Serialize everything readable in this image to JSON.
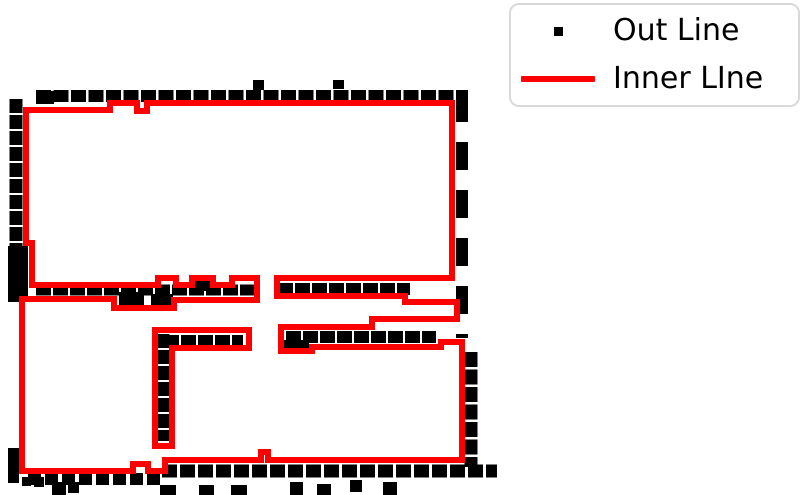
{
  "figure": {
    "background": "#ffffff"
  },
  "legend": {
    "position": "upper right",
    "border_color": "#d9d9d9",
    "items": [
      {
        "label": "Out Line",
        "color": "#000000",
        "marker": "square"
      },
      {
        "label": "Inner LIne",
        "color": "#ff0000",
        "marker": "line"
      }
    ]
  },
  "chart_data": {
    "type": "line",
    "title": "",
    "axes_visible": false,
    "grid": false,
    "coordinate_units": "image pixels, y-down, canvas 800x495",
    "legend_position": "upper right",
    "series": [
      {
        "name": "Out Line",
        "kind": "scatter",
        "marker": "square",
        "color": "#000000",
        "segments": [
          [
            36,
            96,
            466,
            96,
            12,
            "15 2.5"
          ],
          [
            16,
            99,
            16,
            302,
            13,
            "14 2"
          ],
          [
            462,
            94,
            462,
            338,
            12,
            "28 20"
          ],
          [
            471,
            352,
            471,
            467,
            13,
            "15 2.5"
          ],
          [
            36,
            290,
            256,
            290,
            11,
            "15 2"
          ],
          [
            278,
            289,
            410,
            289,
            12,
            "15 2"
          ],
          [
            164,
            341,
            243,
            341,
            12,
            "15 2"
          ],
          [
            163,
            334,
            163,
            441,
            13,
            "14 2"
          ],
          [
            286,
            337,
            436,
            337,
            12,
            "15 2"
          ],
          [
            28,
            479,
            160,
            479,
            12,
            "13 4"
          ],
          [
            162,
            471,
            497,
            471,
            13,
            "15 3"
          ]
        ],
        "blocks": [
          [
            8,
            448,
            11,
            35
          ],
          [
            8,
            246,
            20,
            56
          ],
          [
            36,
            91,
            18,
            13
          ],
          [
            456,
            90,
            12,
            22
          ],
          [
            119,
            292,
            25,
            13
          ],
          [
            151,
            294,
            22,
            12
          ],
          [
            195,
            281,
            16,
            10
          ],
          [
            283,
            340,
            26,
            11
          ],
          [
            253,
            80,
            11,
            10
          ],
          [
            333,
            80,
            11,
            9
          ]
        ],
        "dots": [
          [
            22,
            477,
            9
          ],
          [
            34,
            477,
            10
          ],
          [
            52,
            482,
            14
          ],
          [
            68,
            482,
            11
          ],
          [
            160,
            485,
            16
          ],
          [
            199,
            485,
            15
          ],
          [
            231,
            485,
            16
          ],
          [
            290,
            482,
            13
          ],
          [
            317,
            484,
            14
          ],
          [
            350,
            480,
            12
          ],
          [
            383,
            482,
            14
          ]
        ]
      },
      {
        "name": "Inner LIne",
        "kind": "line",
        "color": "#ff0000",
        "line_width": 6,
        "loops": [
          {
            "name": "outer-boundary",
            "closed": true,
            "points": [
              [
                26,
                110
              ],
              [
                110,
                110
              ],
              [
                110,
                103
              ],
              [
                137,
                103
              ],
              [
                137,
                111
              ],
              [
                147,
                111
              ],
              [
                147,
                103
              ],
              [
                452,
                103
              ],
              [
                452,
                278
              ],
              [
                277,
                278
              ],
              [
                277,
                296
              ],
              [
                405,
                296
              ],
              [
                405,
                302
              ],
              [
                457,
                302
              ],
              [
                457,
                319
              ],
              [
                372,
                319
              ],
              [
                372,
                327
              ],
              [
                281,
                327
              ],
              [
                281,
                351
              ],
              [
                312,
                351
              ],
              [
                312,
                347
              ],
              [
                441,
                347
              ],
              [
                441,
                342
              ],
              [
                462,
                342
              ],
              [
                462,
                460
              ],
              [
                268,
                460
              ],
              [
                268,
                452
              ],
              [
                261,
                452
              ],
              [
                261,
                460
              ],
              [
                165,
                460
              ],
              [
                165,
                471
              ],
              [
                148,
                471
              ],
              [
                148,
                464
              ],
              [
                133,
                464
              ],
              [
                133,
                471
              ],
              [
                22,
                471
              ],
              [
                22,
                299
              ],
              [
                114,
                299
              ],
              [
                114,
                308
              ],
              [
                174,
                308
              ],
              [
                174,
                300
              ],
              [
                257,
                300
              ],
              [
                257,
                278
              ],
              [
                232,
                278
              ],
              [
                232,
                285
              ],
              [
                213,
                285
              ],
              [
                213,
                278
              ],
              [
                192,
                278
              ],
              [
                192,
                285
              ],
              [
                176,
                285
              ],
              [
                176,
                278
              ],
              [
                158,
                278
              ],
              [
                158,
                285
              ],
              [
                32,
                285
              ],
              [
                32,
                243
              ],
              [
                26,
                243
              ]
            ]
          },
          {
            "name": "island-wall",
            "closed": true,
            "points": [
              [
                155,
                330
              ],
              [
                249,
                330
              ],
              [
                249,
                348
              ],
              [
                172,
                348
              ],
              [
                172,
                446
              ],
              [
                155,
                446
              ]
            ]
          }
        ]
      }
    ]
  }
}
